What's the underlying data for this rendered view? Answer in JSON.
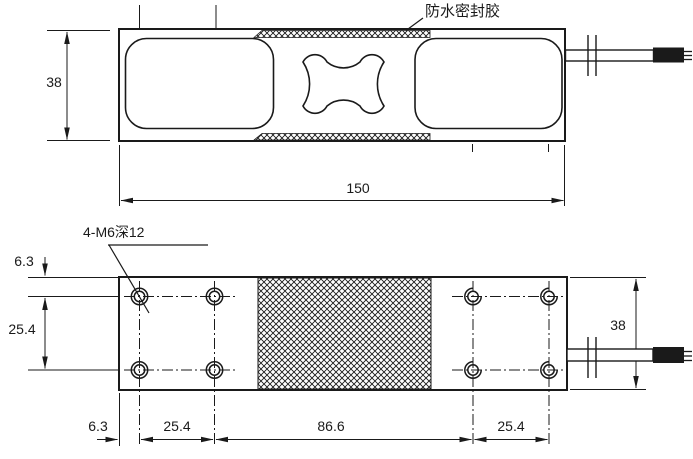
{
  "labels": {
    "sealant": "防水密封胶",
    "thread_note": "4-M6深12"
  },
  "side_view": {
    "height": "38",
    "length": "150"
  },
  "plan_view": {
    "top_margin": "6.3",
    "row_spacing": "25.4",
    "left_margin": "6.3",
    "col_spacing_left": "25.4",
    "center_span": "86.6",
    "col_spacing_right": "25.4",
    "height": "38"
  },
  "colors": {
    "line": "#1a1a1a",
    "background": "#ffffff"
  }
}
